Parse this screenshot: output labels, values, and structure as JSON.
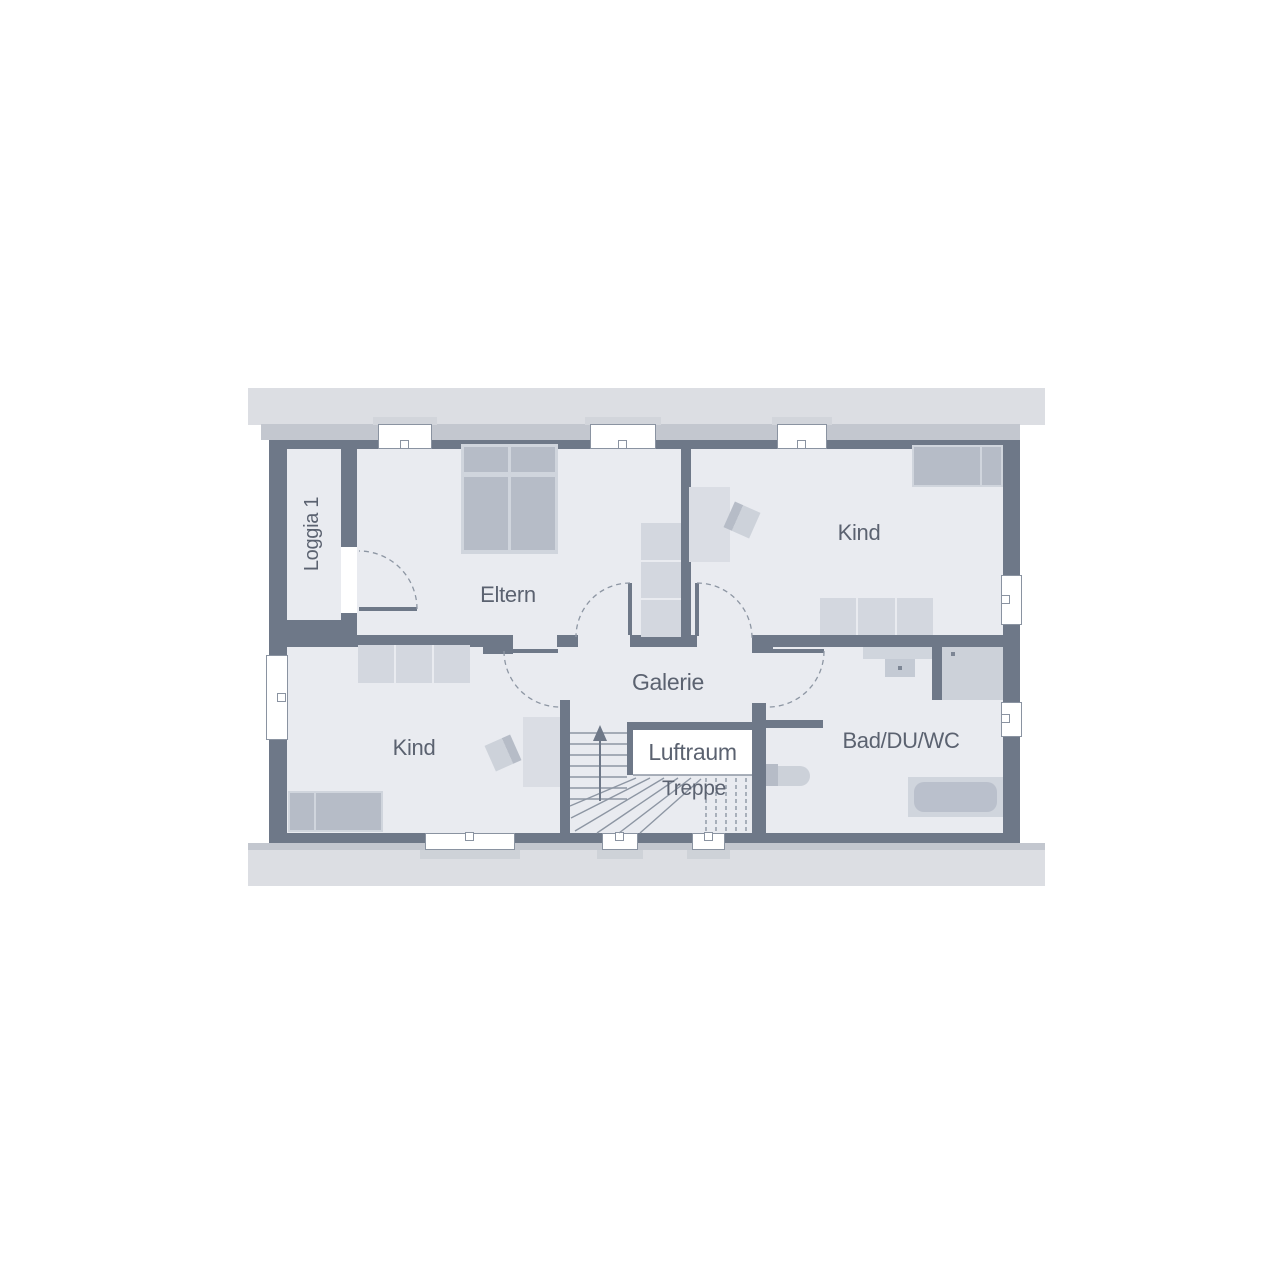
{
  "rooms": {
    "loggia": {
      "label": "Loggia 1"
    },
    "parents": {
      "label": "Eltern"
    },
    "child_top": {
      "label": "Kind"
    },
    "child_bottom": {
      "label": "Kind"
    },
    "gallery": {
      "label": "Galerie"
    },
    "void": {
      "label": "Luftraum"
    },
    "stairs": {
      "label": "Treppe"
    },
    "bath": {
      "label": "Bad/DU/WC"
    }
  },
  "colors": {
    "wall": "#6e7888",
    "room_fill": "#e9ebf0",
    "roof_band": "#dcdee3",
    "roof_strip": "#c3c7cf",
    "furniture_light": "#d0d5dd",
    "furniture_dark": "#b6bcc7",
    "line": "#8d96a3",
    "label_text": "#5b6270",
    "window": "#ffffff"
  }
}
